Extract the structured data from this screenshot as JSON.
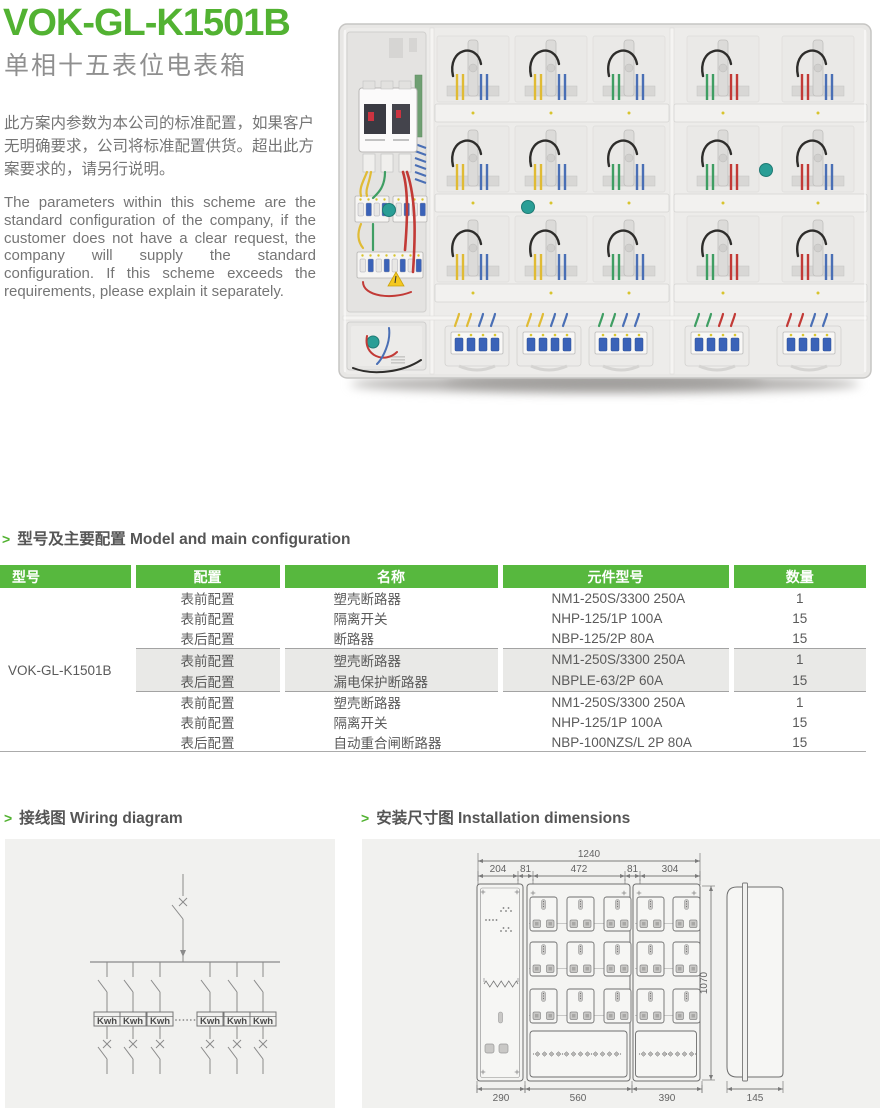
{
  "page": {
    "title": "VOK-GL-K1501B",
    "subtitle": "单相十五表位电表箱",
    "description_zh": "此方案内参数为本公司的标准配置，如果客户无明确要求，公司将标准配置供货。超出此方案要求的，请另行说明。",
    "description_en": "The parameters within this scheme are the standard configuration of the company, if the customer does not have a clear request, the company will supply the standard configuration. If this scheme exceeds the requirements, please explain it separately."
  },
  "colors": {
    "accent_green": "#52b232",
    "table_header_green": "#57b83e",
    "heading_gray": "#555555",
    "body_gray": "#757575",
    "panel_bg": "#f1f1ef",
    "shaded_row": "#e9e9e7",
    "wire_yellow": "#e0bb35",
    "wire_blue": "#4a6fb5",
    "wire_green": "#3f9e63",
    "wire_red": "#c23a36",
    "wire_black": "#2e2d2b",
    "knob_teal": "#2a9e96"
  },
  "sections": {
    "model_config": {
      "marker": ">",
      "title": "型号及主要配置 Model and main configuration"
    },
    "wiring": {
      "marker": ">",
      "title": "接线图 Wiring diagram"
    },
    "installation": {
      "marker": ">",
      "title": "安装尺寸图 Installation dimensions"
    }
  },
  "table": {
    "headers": [
      "型号",
      "配置",
      "名称",
      "元件型号",
      "数量"
    ],
    "model": "VOK-GL-K1501B",
    "groups": [
      {
        "shaded": false,
        "rows": [
          {
            "config": "表前配置",
            "name": "塑壳断路器",
            "part": "NM1-250S/3300 250A",
            "qty": "1"
          },
          {
            "config": "表前配置",
            "name": "隔离开关",
            "part": "NHP-125/1P 100A",
            "qty": "15"
          },
          {
            "config": "表后配置",
            "name": "断路器",
            "part": "NBP-125/2P 80A",
            "qty": "15"
          }
        ]
      },
      {
        "shaded": true,
        "rows": [
          {
            "config": "表前配置",
            "name": "塑壳断路器",
            "part": "NM1-250S/3300 250A",
            "qty": "1"
          },
          {
            "config": "表后配置",
            "name": "漏电保护断路器",
            "part": "NBPLE-63/2P 60A",
            "qty": "15"
          }
        ]
      },
      {
        "shaded": false,
        "rows": [
          {
            "config": "表前配置",
            "name": "塑壳断路器",
            "part": "NM1-250S/3300 250A",
            "qty": "1"
          },
          {
            "config": "表前配置",
            "name": "隔离开关",
            "part": "NHP-125/1P 100A",
            "qty": "15"
          },
          {
            "config": "表后配置",
            "name": "自动重合闸断路器",
            "part": "NBP-100NZS/L 2P 80A",
            "qty": "15"
          }
        ]
      }
    ]
  },
  "wiring_diagram": {
    "meter_label": "Kwh",
    "meter_count": 6,
    "separator_dots": "······"
  },
  "installation": {
    "total_width": "1240",
    "top_segments": [
      "204",
      "81",
      "472",
      "81",
      "304"
    ],
    "height": "1070",
    "bottom_widths": [
      "290",
      "560",
      "390"
    ],
    "depth": "145"
  }
}
